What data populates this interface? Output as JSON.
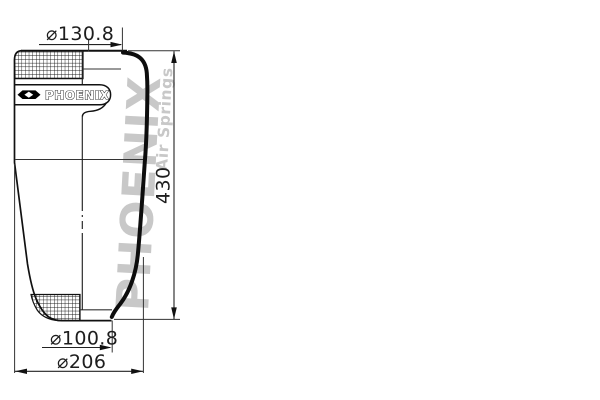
{
  "drawing": {
    "title": "Air spring bellows side-view technical drawing"
  },
  "watermark": {
    "brand": "PHOENIX",
    "tagline": "Air Springs",
    "color": "#c8c8c8"
  },
  "brand_plate": {
    "label": "PHOENIX",
    "logo_icon": "phoenix-diamond-icon"
  },
  "dimensions": {
    "top_diameter": {
      "label": "⌀130.8"
    },
    "height": {
      "label": "430"
    },
    "bottom_diameter": {
      "label": "⌀100.8"
    },
    "max_diameter": {
      "label": "⌀206"
    }
  },
  "colors": {
    "line": "#1a1a1a",
    "watermark": "#c8c8c8",
    "background": "#ffffff"
  }
}
